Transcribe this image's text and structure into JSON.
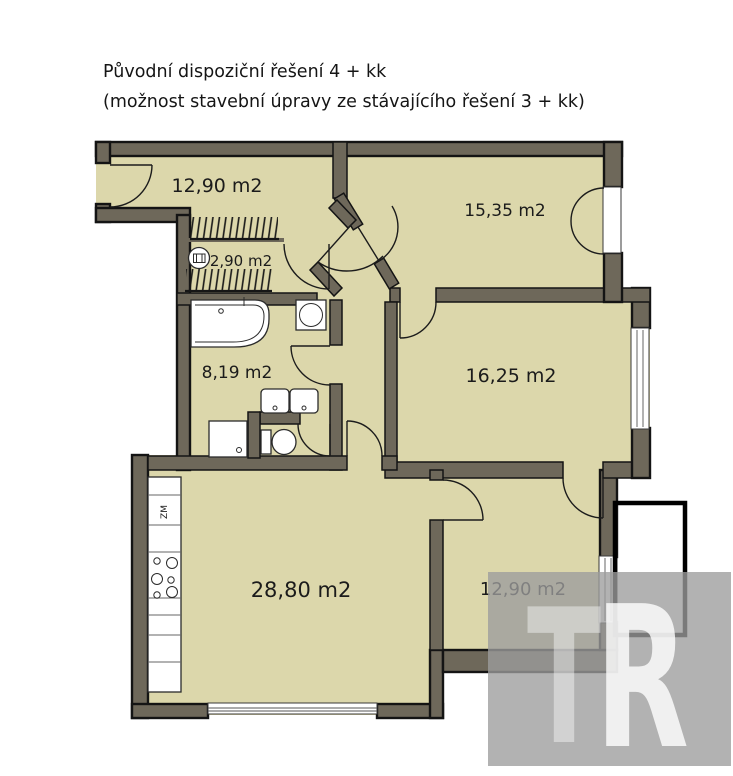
{
  "title": {
    "line1": "Původní dispoziční řešení 4 + kk",
    "line2": "(možnost stavební úpravy ze stávajícího řešení 3 + kk)"
  },
  "rooms": {
    "hall": {
      "area_label": "12,90 m2"
    },
    "pantry": {
      "area_label": "2,90 m2"
    },
    "bathroom": {
      "area_label": "8,19 m2"
    },
    "bedroom_top_right": {
      "area_label": "15,35 m2"
    },
    "bedroom_middle_right": {
      "area_label": "16,25 m2"
    },
    "living_kitchen": {
      "area_label": "28,80 m2"
    },
    "bedroom_bottom_right": {
      "area_label": "12,90 m2"
    }
  },
  "kitchen": {
    "appliance_label": "ZM"
  },
  "icons": {
    "washing_machine": "washing-machine-icon",
    "cooktop": "cooktop-burners-icon",
    "wardrobe_hatch": "wardrobe-hatch-icon"
  },
  "watermark": {
    "letter_t": "T",
    "letter_r": "R"
  },
  "colors": {
    "floor": "#dcd7ab",
    "wall": "#6e685a",
    "outline": "#141414",
    "watermark_box": "#9c9c9c"
  }
}
